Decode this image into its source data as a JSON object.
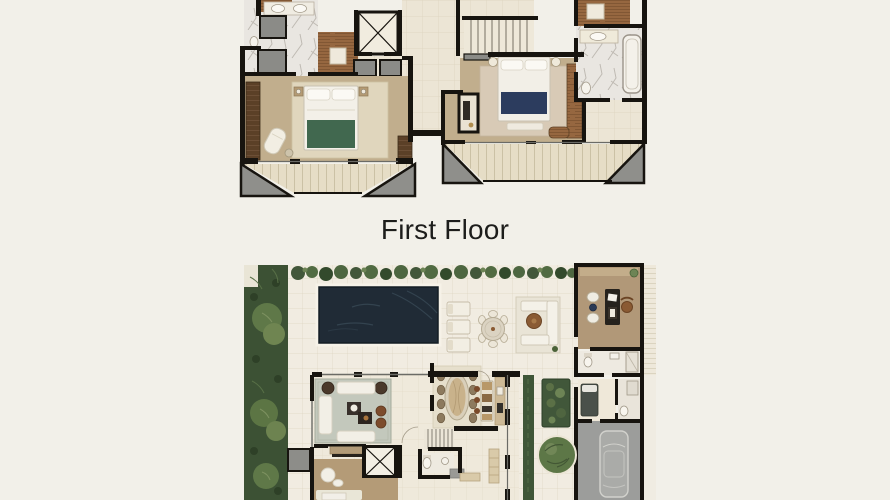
{
  "page": {
    "background_color": "#f2f0e9",
    "width": 890,
    "height": 500,
    "content": "Two architectural floor-plan renderings stacked vertically with a caption between them"
  },
  "caption": {
    "text": "First Floor"
  },
  "plans": {
    "upper_floor": {
      "label": "Upper floor plan (cropped at top edge)",
      "regions": [
        "bedroom-suite-left",
        "bathroom-left",
        "walk-in-closet-left",
        "elevator",
        "stair-hall",
        "staircase",
        "bedroom-suite-right",
        "bathroom-right",
        "closet-right",
        "balcony-left",
        "balcony-right"
      ],
      "furnishings": [
        "bed-green-throw",
        "bed-navy-throw",
        "chaise-lounge",
        "nightstands",
        "bathtub",
        "double-vanity",
        "wardrobes"
      ]
    },
    "first_floor": {
      "label": "First Floor",
      "regions": [
        "side-garden",
        "hedge-row",
        "swimming-pool",
        "pool-terrace",
        "sun-loungers",
        "outdoor-dining",
        "outdoor-lounge",
        "study",
        "guest-bathroom",
        "staff-room",
        "living-room",
        "tv-lounge",
        "elevator",
        "dining-room",
        "kitchen",
        "staircase",
        "powder-room",
        "entry-walkway",
        "planter-boxes",
        "courtyard-tree",
        "garage",
        "car"
      ]
    }
  },
  "colors": {
    "background": "#f2f0e9",
    "caption_text": "#1d1d1b",
    "walls": "#17140f",
    "floor_tile": "#ece5d5",
    "marble": "#e9e6e1",
    "bedroom_floor": "#c1ae8d",
    "wood_closet": "#966740",
    "dark_wood": "#5b4027",
    "balcony_deck": "#e6ddc6",
    "shaft_gray": "#8b8b87",
    "bed_green_throw": "#41684f",
    "bed_navy_throw": "#2c3c5e",
    "pool_water": "#202b36",
    "garden_green": "#3c5134",
    "tree_green": "#5f7848",
    "living_rug": "#c3c8bc",
    "garage_floor": "#9c9d9b",
    "study_floor": "#b19878"
  }
}
